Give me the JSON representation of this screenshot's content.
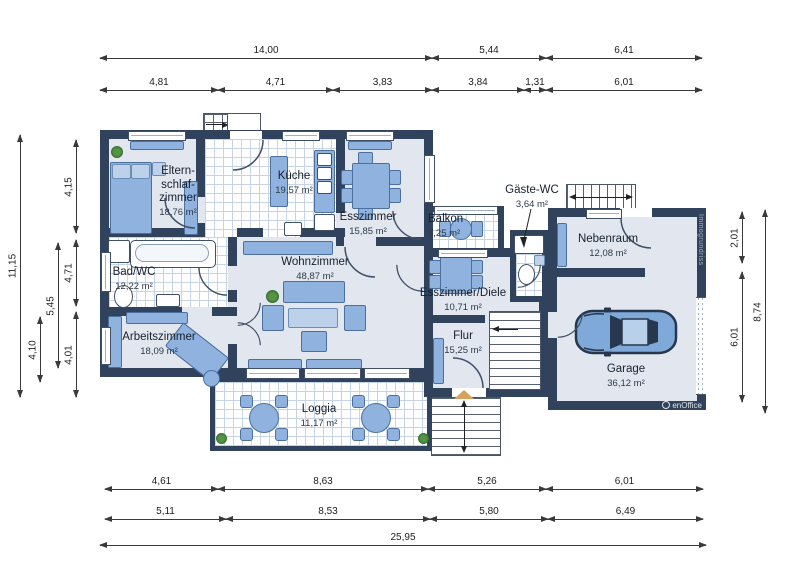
{
  "plan": {
    "rooms": {
      "eltern": {
        "lines": [
          "Eltern-",
          "schlaf-",
          "zimmer"
        ],
        "area": "18,76 m²"
      },
      "kueche": {
        "name": "Küche",
        "area": "19,57 m²"
      },
      "esszimmer": {
        "name": "Esszimmer",
        "area": "15,85 m²"
      },
      "balkon": {
        "name": "Balkon",
        "area": "9,25 m²"
      },
      "gaeste_wc": {
        "name": "Gäste-WC",
        "area": "3,64 m²"
      },
      "nebenraum": {
        "name": "Nebenraum",
        "area": "12,08 m²"
      },
      "bad_wc": {
        "name": "Bad/WC",
        "area": "12,22 m²"
      },
      "wohnzimmer": {
        "name": "Wohnzimmer",
        "area": "48,87 m²"
      },
      "diele": {
        "name": "Esszimmer/Diele",
        "area": "10,71 m²"
      },
      "arbeitszimmer": {
        "name": "Arbeitszimmer",
        "area": "18,09 m²"
      },
      "flur": {
        "name": "Flur",
        "area": "15,25 m²"
      },
      "garage": {
        "name": "Garage",
        "area": "36,12 m²"
      },
      "loggia": {
        "name": "Loggia",
        "area": "11,17 m²"
      }
    },
    "dimensions": {
      "top_row1": [
        "14,00",
        "5,44",
        "6,41"
      ],
      "top_row2": [
        "4,81",
        "4,71",
        "3,83",
        "3,84",
        "1,31",
        "6,01"
      ],
      "bottom_row1": [
        "4,61",
        "8,63",
        "5,26",
        "6,01"
      ],
      "bottom_row2": [
        "5,11",
        "8,53",
        "5,80",
        "6,49"
      ],
      "bottom_total": "25,95",
      "left_outer": "11,15",
      "left_mid": [
        "4,10",
        "5,45"
      ],
      "left_inner": [
        "4,15",
        "4,71",
        "4,01"
      ],
      "right_inner": [
        "2,01",
        "6,01"
      ],
      "right_outer": "8,74"
    },
    "watermarks": {
      "wall_text": "Immogrundriss",
      "logo_text": "enOffice"
    },
    "colors": {
      "wall": "#31435c",
      "floor": "#e2e7ef",
      "furniture": "#8fb3de",
      "tile_line": "#c7d4e5",
      "accent_triangle": "#d7a160"
    }
  }
}
